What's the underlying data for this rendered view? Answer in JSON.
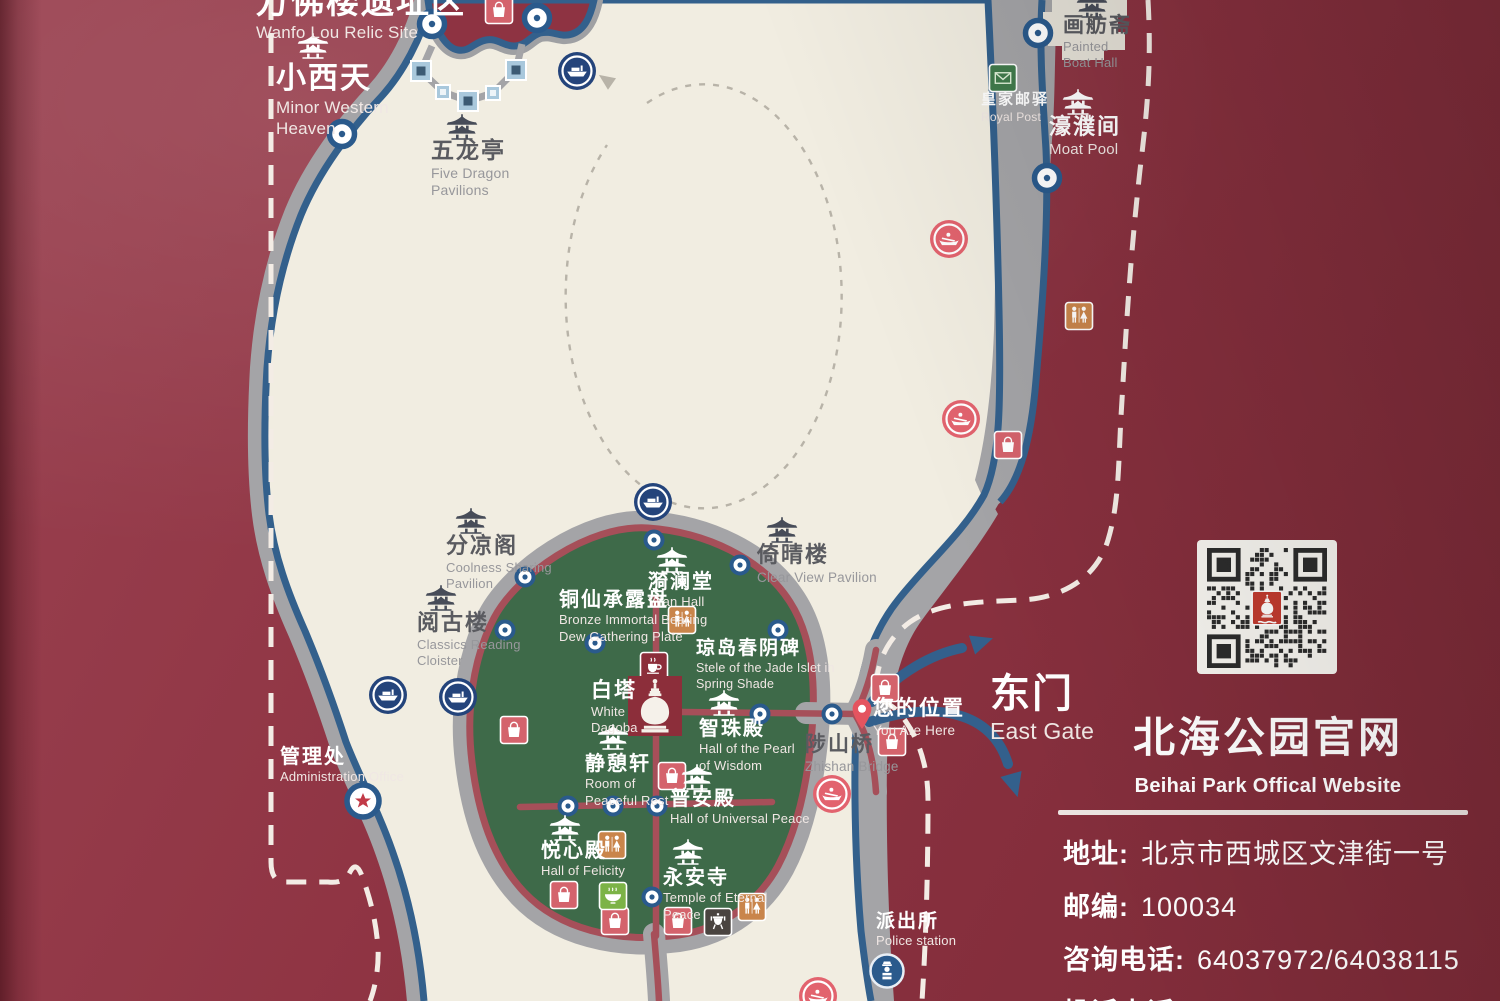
{
  "colors": {
    "bg": "#8e3342",
    "lake": "#f1ede1",
    "shore": "#a4a4a7",
    "water": "#33608c",
    "island": "#3e6a49",
    "road": "#a64f59",
    "node": "#2a5a8c",
    "dock_blue": "#24447b",
    "dock_pink": "#e2636e",
    "wc": "#c9854b",
    "shop": "#d4636c",
    "mail": "#417b4c",
    "cafe": "#8c2e3a",
    "food": "#7cb347",
    "incense": "#4a4440",
    "star": "#c23a47",
    "pin": "#e4545f",
    "square": "#a9c8dc",
    "square_core": "#3c5a73",
    "dash": "#f3ece5",
    "route": "#b8b3a8",
    "qr_dark": "#2c2c2c",
    "logo_red": "#c23b30",
    "pavilion_dark": "#474c58",
    "pavilion_light": "#ffffff"
  },
  "map": {
    "labels": [
      {
        "id": "wanfo-lou-relic-site",
        "zh": "万佛楼遗址区",
        "en": [
          "Wanfo Lou Relic Site"
        ],
        "x": 256,
        "y": -16,
        "tone": "light",
        "zs": 33,
        "es": 17
      },
      {
        "id": "minor-western-heaven",
        "zh": "小西天",
        "en": [
          "Minor Western",
          "Heaven"
        ],
        "x": 276,
        "y": 62,
        "tone": "light",
        "zs": 30,
        "es": 17
      },
      {
        "id": "five-dragon-pavilions",
        "zh": "五龙亭",
        "en": [
          "Five Dragon",
          "Pavilions"
        ],
        "x": 431,
        "y": 138,
        "tone": "dark",
        "zs": 23,
        "es": 14
      },
      {
        "id": "painted-boat-hall",
        "zh": "画舫斋",
        "en": [
          "Painted",
          "Boat Hall"
        ],
        "x": 1063,
        "y": 14,
        "tone": "dark",
        "zs": 21,
        "es": 13
      },
      {
        "id": "royal-post",
        "zh": "皇家邮驿",
        "en": [
          "Royal Post"
        ],
        "x": 981,
        "y": 92,
        "tone": "light",
        "zs": 15,
        "es": 12
      },
      {
        "id": "moat-pool",
        "zh": "濠濮间",
        "en": [
          "Moat Pool"
        ],
        "x": 1049,
        "y": 115,
        "tone": "light",
        "zs": 22,
        "es": 15
      },
      {
        "id": "coolness-sharing-pavilion",
        "zh": "分凉阁",
        "en": [
          "Coolness Sharing",
          "Pavilion"
        ],
        "x": 446,
        "y": 534,
        "tone": "dark",
        "zs": 22,
        "es": 13
      },
      {
        "id": "classics-reading-cloister",
        "zh": "阅古楼",
        "en": [
          "Classics Reading",
          "Cloister"
        ],
        "x": 417,
        "y": 611,
        "tone": "dark",
        "zs": 22,
        "es": 13
      },
      {
        "id": "yilan-hall",
        "zh": "漪澜堂",
        "en": [
          "Yilan Hall"
        ],
        "x": 648,
        "y": 571,
        "tone": "light",
        "zs": 20,
        "es": 13
      },
      {
        "id": "bronze-immortal-plate",
        "zh": "铜仙承露盘",
        "en": [
          "Bronze Immortal Bearing",
          "Dew Gathering Plate"
        ],
        "x": 559,
        "y": 589,
        "tone": "light",
        "zs": 20,
        "es": 13
      },
      {
        "id": "stele-jade-islet",
        "zh": "琼岛春阴碑",
        "en": [
          "Stele of the Jade Islet in",
          "Spring Shade"
        ],
        "x": 696,
        "y": 638,
        "tone": "light",
        "zs": 19,
        "es": 12.5
      },
      {
        "id": "white-dagoba",
        "zh": "白塔",
        "en": [
          "White",
          "Dagoba"
        ],
        "x": 591,
        "y": 679,
        "tone": "light",
        "zs": 21,
        "es": 13
      },
      {
        "id": "hall-pearl-of-wisdom",
        "zh": "智珠殿",
        "en": [
          "Hall of the Pearl",
          "of Wisdom"
        ],
        "x": 699,
        "y": 718,
        "tone": "light",
        "zs": 20,
        "es": 13
      },
      {
        "id": "room-peaceful-rest",
        "zh": "静憩轩",
        "en": [
          "Room of",
          "Peaceful Rest"
        ],
        "x": 585,
        "y": 753,
        "tone": "light",
        "zs": 20,
        "es": 13
      },
      {
        "id": "hall-universal-peace",
        "zh": "普安殿",
        "en": [
          "Hall of Universal Peace"
        ],
        "x": 670,
        "y": 788,
        "tone": "light",
        "zs": 20,
        "es": 13
      },
      {
        "id": "hall-of-felicity",
        "zh": "悦心殿",
        "en": [
          "Hall of Felicity"
        ],
        "x": 541,
        "y": 840,
        "tone": "light",
        "zs": 20,
        "es": 13
      },
      {
        "id": "temple-eternal-peace",
        "zh": "永安寺",
        "en": [
          "Temple of Eternal",
          "Peace"
        ],
        "x": 663,
        "y": 867,
        "tone": "light",
        "zs": 20,
        "es": 13
      },
      {
        "id": "clear-view-pavilion",
        "zh": "倚晴楼",
        "en": [
          "Clear View Pavilion"
        ],
        "x": 757,
        "y": 543,
        "tone": "dark",
        "zs": 22,
        "es": 13.5
      },
      {
        "id": "zhishan-bridge",
        "zh": "陟山桥",
        "en": [
          "Zhishan Bridge"
        ],
        "x": 805,
        "y": 733,
        "tone": "dark",
        "zs": 21,
        "es": 13.5
      },
      {
        "id": "you-are-here",
        "zh": "您的位置",
        "en": [
          "You Are Here"
        ],
        "x": 873,
        "y": 697,
        "tone": "light",
        "zs": 21,
        "es": 13.5
      },
      {
        "id": "east-gate",
        "zh": "东门",
        "en": [
          "East Gate"
        ],
        "x": 990,
        "y": 672,
        "tone": "light",
        "zs": 40,
        "es": 23
      },
      {
        "id": "administration-office",
        "zh": "管理处",
        "en": [
          "Administration Office"
        ],
        "x": 280,
        "y": 746,
        "tone": "light",
        "zs": 20,
        "es": 13
      },
      {
        "id": "police-station",
        "zh": "派出所",
        "en": [
          "Police station"
        ],
        "x": 876,
        "y": 911,
        "tone": "light",
        "zs": 19,
        "es": 13
      }
    ],
    "pavilion_icons": [
      {
        "x": 313,
        "y": 46,
        "tone": "light"
      },
      {
        "x": 462,
        "y": 127,
        "tone": "dark"
      },
      {
        "x": 1092,
        "y": 5,
        "tone": "dark"
      },
      {
        "x": 1078,
        "y": 102,
        "tone": "light"
      },
      {
        "x": 471,
        "y": 521,
        "tone": "dark"
      },
      {
        "x": 441,
        "y": 598,
        "tone": "dark"
      },
      {
        "x": 672,
        "y": 560,
        "tone": "light"
      },
      {
        "x": 724,
        "y": 703,
        "tone": "light"
      },
      {
        "x": 613,
        "y": 737,
        "tone": "light"
      },
      {
        "x": 697,
        "y": 777,
        "tone": "light"
      },
      {
        "x": 565,
        "y": 828,
        "tone": "light"
      },
      {
        "x": 688,
        "y": 852,
        "tone": "light"
      },
      {
        "x": 782,
        "y": 530,
        "tone": "dark"
      }
    ],
    "nodes_lg": [
      [
        432,
        24
      ],
      [
        537,
        18
      ],
      [
        342,
        134
      ],
      [
        1038,
        33
      ],
      [
        1047,
        178
      ]
    ],
    "nodes_sm": [
      [
        525,
        577
      ],
      [
        505,
        630
      ],
      [
        654,
        540
      ],
      [
        740,
        565
      ],
      [
        778,
        630
      ],
      [
        760,
        714
      ],
      [
        832,
        714
      ],
      [
        568,
        806
      ],
      [
        613,
        806
      ],
      [
        657,
        806
      ],
      [
        652,
        897
      ],
      [
        595,
        643
      ]
    ],
    "docks_blue": [
      [
        577,
        71
      ],
      [
        653,
        502
      ],
      [
        388,
        695
      ],
      [
        458,
        697
      ]
    ],
    "docks_pink": [
      [
        949,
        239
      ],
      [
        961,
        419
      ],
      [
        832,
        794
      ],
      [
        818,
        996
      ]
    ],
    "squares_lg": [
      [
        421,
        71
      ],
      [
        468,
        101
      ],
      [
        516,
        70
      ]
    ],
    "squares_sm": [
      [
        443,
        92
      ],
      [
        493,
        93
      ]
    ],
    "amenities": [
      {
        "type": "wc",
        "x": 682,
        "y": 620
      },
      {
        "type": "wc",
        "x": 612,
        "y": 845
      },
      {
        "type": "wc",
        "x": 752,
        "y": 907
      },
      {
        "type": "wc",
        "x": 1079,
        "y": 316
      },
      {
        "type": "shop",
        "x": 499,
        "y": 10
      },
      {
        "type": "shop",
        "x": 1008,
        "y": 445
      },
      {
        "type": "shop",
        "x": 885,
        "y": 688
      },
      {
        "type": "shop",
        "x": 892,
        "y": 742
      },
      {
        "type": "shop",
        "x": 514,
        "y": 730
      },
      {
        "type": "shop",
        "x": 672,
        "y": 776
      },
      {
        "type": "shop",
        "x": 564,
        "y": 895
      },
      {
        "type": "shop",
        "x": 615,
        "y": 921
      },
      {
        "type": "shop",
        "x": 678,
        "y": 921
      },
      {
        "type": "mail",
        "x": 1003,
        "y": 78
      },
      {
        "type": "cafe",
        "x": 654,
        "y": 666
      },
      {
        "type": "food",
        "x": 613,
        "y": 896
      },
      {
        "type": "incense",
        "x": 718,
        "y": 922
      }
    ],
    "police": [
      887,
      971
    ],
    "admin": [
      363,
      801
    ],
    "pin": [
      862,
      714
    ],
    "dagoba_square": [
      655,
      706
    ]
  },
  "panel": {
    "title_zh": "北海公园官网",
    "title_en": "Beihai Park Offical Website",
    "info": [
      {
        "label": "地址:",
        "value": "北京市西城区文津街一号"
      },
      {
        "label": "邮编:",
        "value": "100034"
      },
      {
        "label": "咨询电话:",
        "value": "64037972/64038115"
      },
      {
        "label": "投诉电话:",
        "value": "64031102"
      }
    ]
  }
}
